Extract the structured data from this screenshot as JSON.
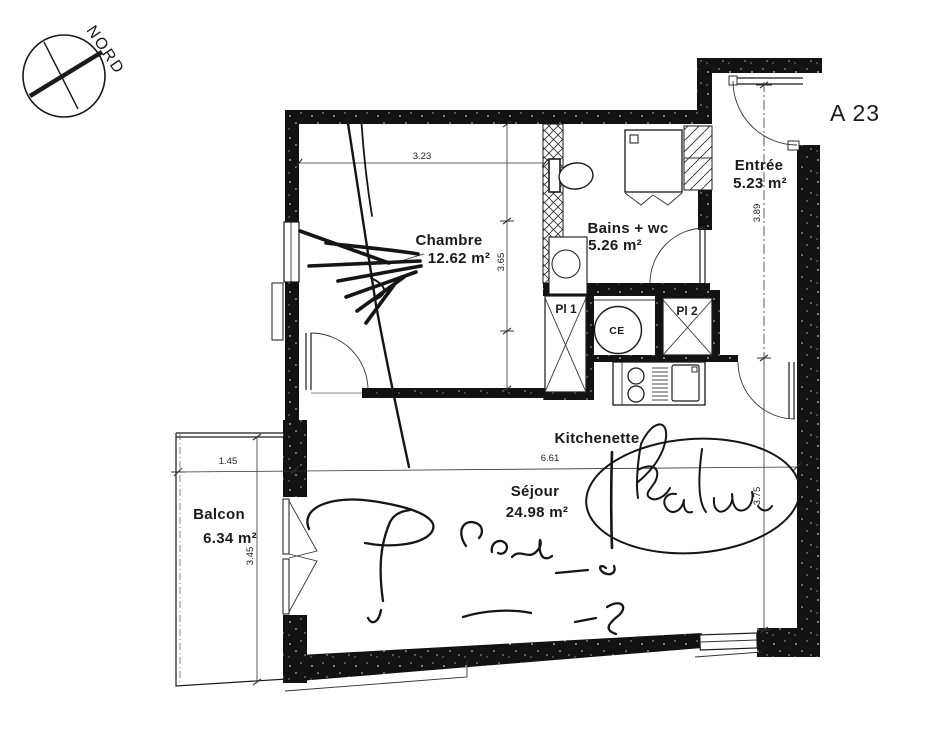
{
  "title": "A 23",
  "compass_label": "NORD",
  "rooms": {
    "chambre": {
      "name": "Chambre",
      "area": "12.62 m²"
    },
    "bains": {
      "name": "Bains + wc",
      "area": "5.26 m²"
    },
    "entree": {
      "name": "Entrée",
      "area": "5.23 m²"
    },
    "sejour": {
      "name": "Séjour",
      "area": "24.98 m²"
    },
    "balcon": {
      "name": "Balcon",
      "area": "6.34 m²"
    },
    "kitchenette": {
      "name": "Kitchenette"
    }
  },
  "fixtures": {
    "closet1": "Pl 1",
    "closet2": "Pl 2",
    "water_heater": "CE"
  },
  "dimensions": {
    "chambre_width": "3.23",
    "chambre_height": "3.65",
    "entree_height": "3.89",
    "sejour_width": "6.61",
    "sejour_height": "3.75",
    "balcon_width": "1.45",
    "balcon_height": "3.45"
  },
  "colors": {
    "ink": "#1a1a1a",
    "wall": "#111111",
    "paper": "#ffffff"
  }
}
